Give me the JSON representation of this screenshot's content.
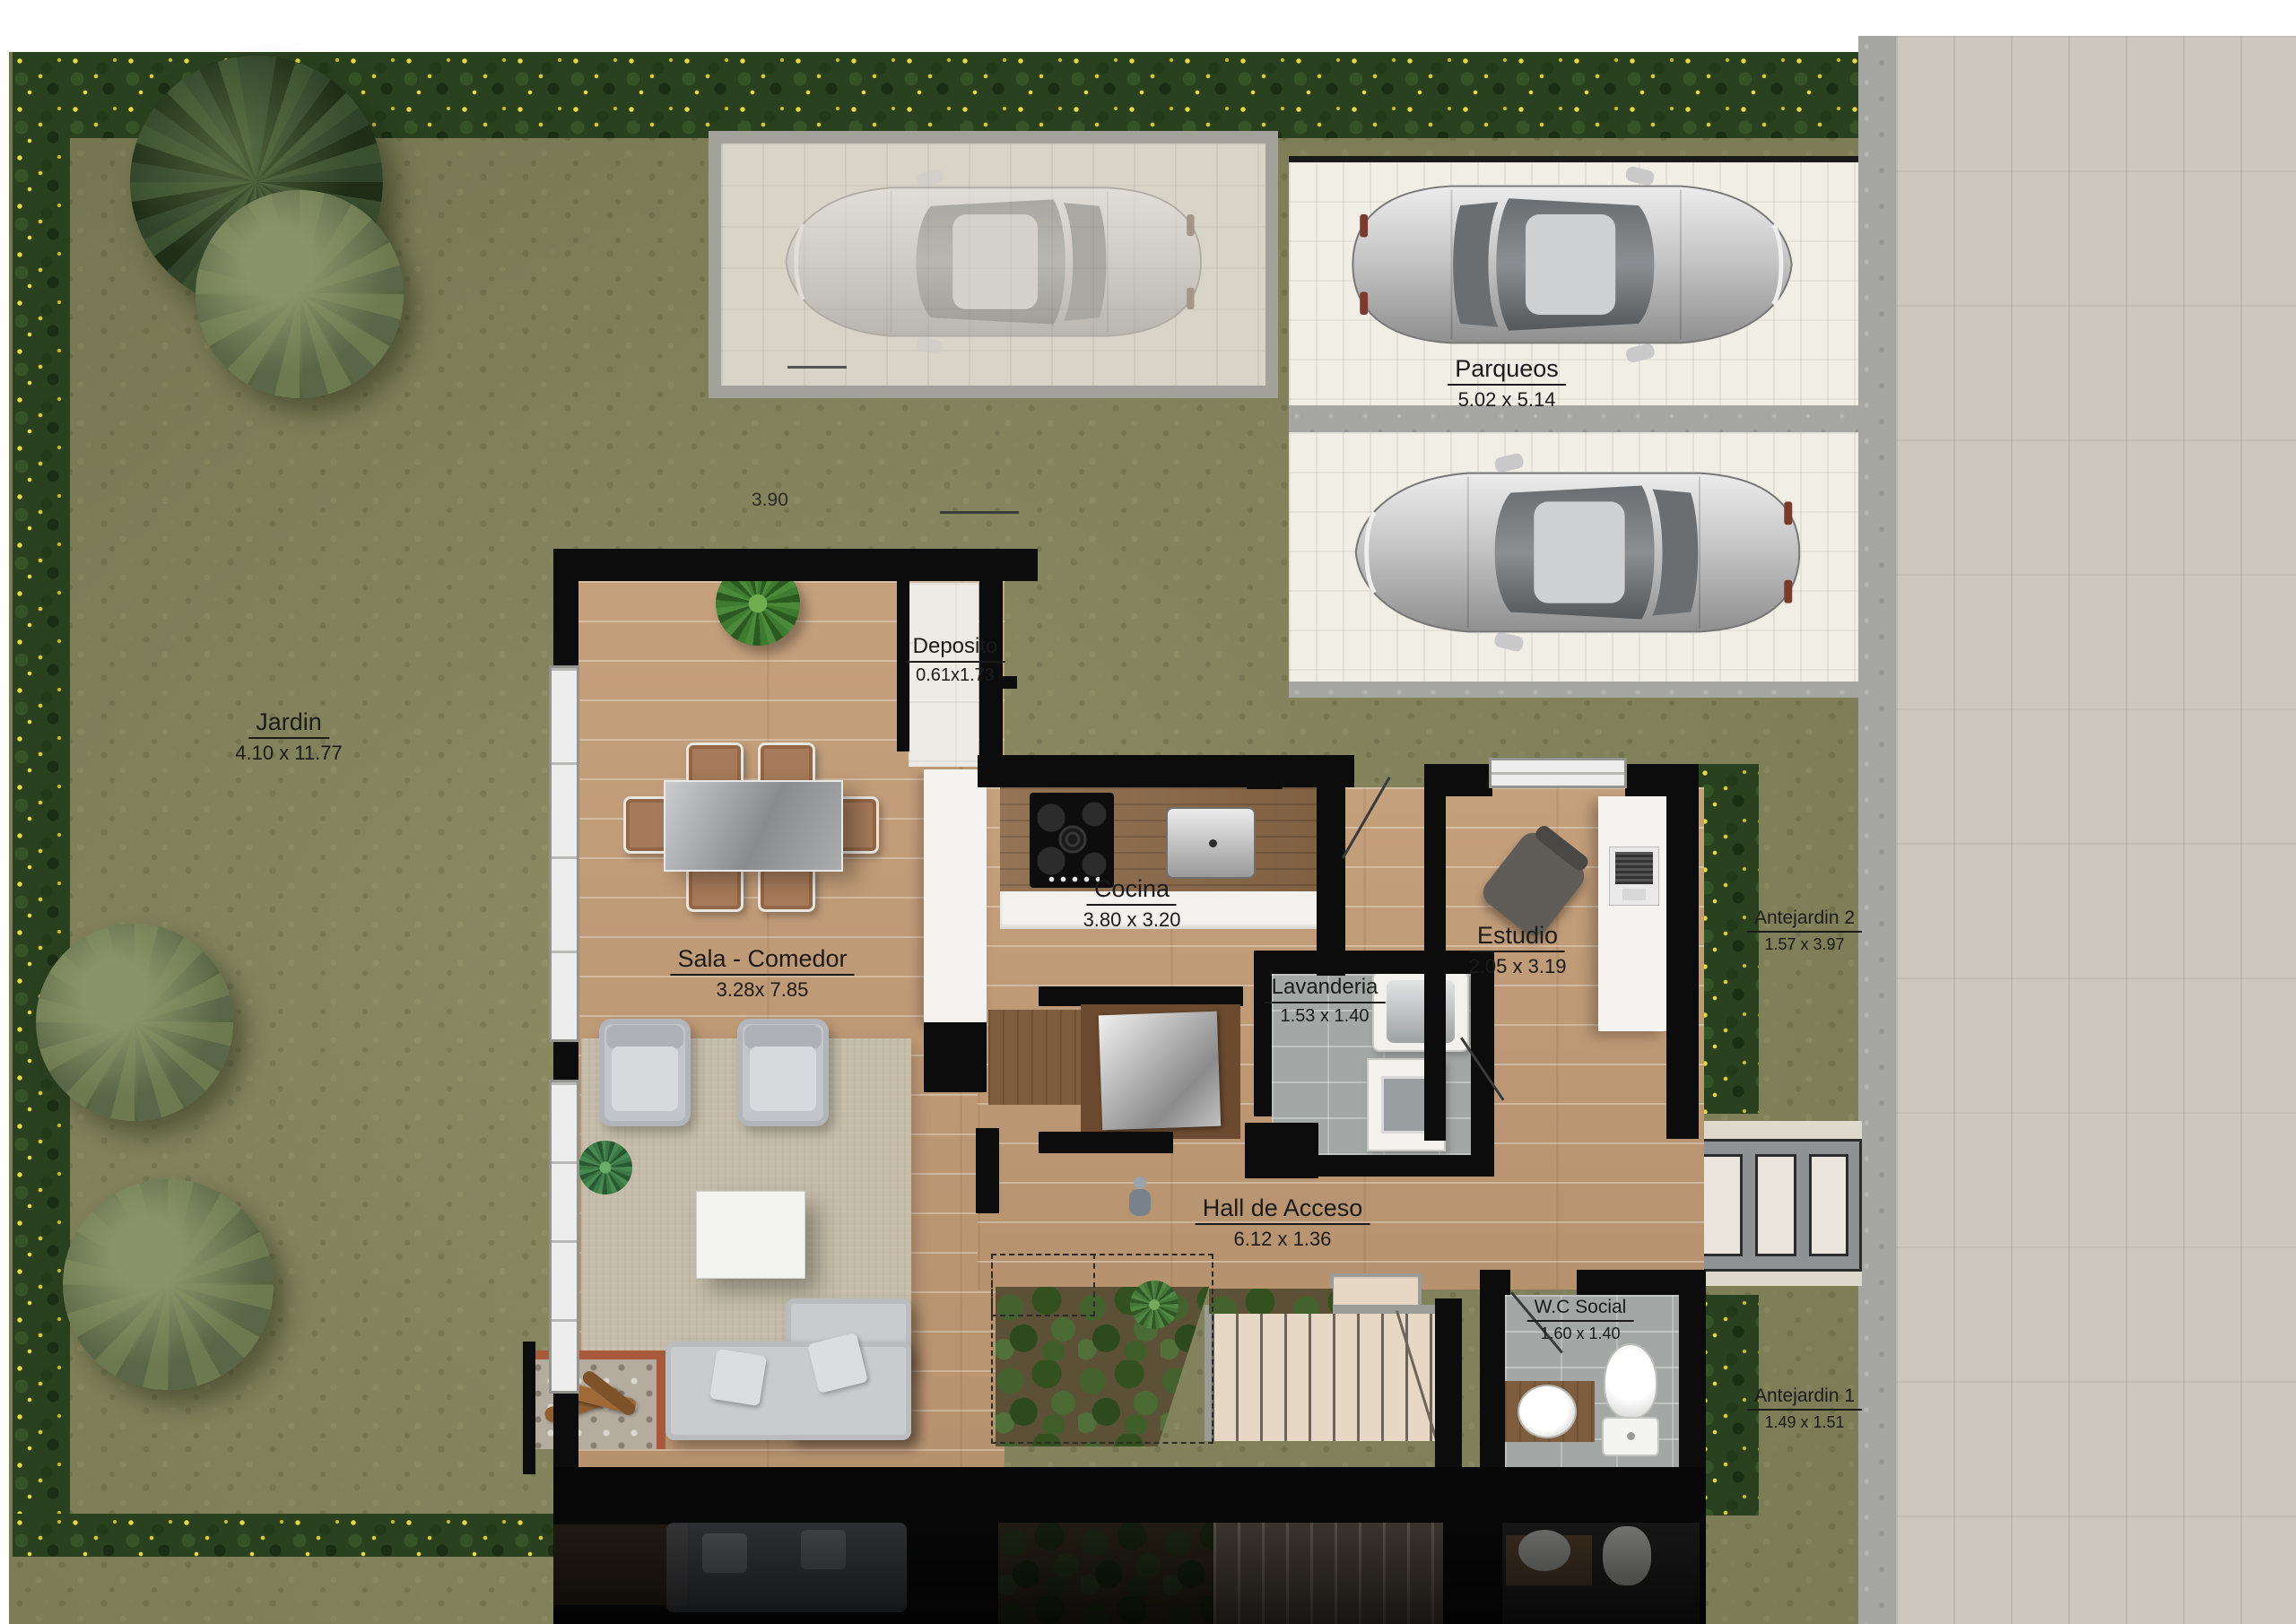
{
  "labels": {
    "parqueos": {
      "name": "Parqueos",
      "dims": "5.02 x 5.14"
    },
    "jardin": {
      "name": "Jardin",
      "dims": "4.10 x 11.77"
    },
    "deposito": {
      "name": "Deposito",
      "dims": "0.61x1.73"
    },
    "cocina": {
      "name": "Cocina",
      "dims": "3.80 x 3.20"
    },
    "estudio": {
      "name": "Estudio",
      "dims": "2.05 x 3.19"
    },
    "sala_comedor": {
      "name": "Sala - Comedor",
      "dims": "3.28x 7.85"
    },
    "lavanderia": {
      "name": "Lavanderia",
      "dims": "1.53 x 1.40"
    },
    "hall_acceso": {
      "name": "Hall de Acceso",
      "dims": "6.12 x 1.36"
    },
    "wc_social": {
      "name": "W.C Social",
      "dims": "1.60 x 1.40"
    },
    "antejardin2": {
      "name": "Antejardin 2",
      "dims": "1.57 x 3.97"
    },
    "antejardin1": {
      "name": "Antejardin 1",
      "dims": "1.49 x 1.51"
    }
  },
  "annotations": {
    "dim_390": "3.90"
  },
  "palette": {
    "grass": "#85855d",
    "hedge_green": "#2a411f",
    "hedge_flower_yellow": "#e7d847",
    "wall_black": "#0c0c0c",
    "wood_floor": "#c29b76",
    "counter_wood": "#8b6847",
    "pale_stair_wood": "#e7d8c5",
    "white_tile": "#edebe5",
    "gray_tile": "#a3a7a5",
    "rug_beige": "#c5bda9",
    "sidewalk_paver": "#ccc7bf",
    "concrete_strip": "#a6a6a3",
    "stall_paver": "#f1eee6",
    "car_silver": "#c9c9c9",
    "label_text": "#1b1b1b"
  },
  "objects": {
    "ghost_car": "faded car on carport pad",
    "parked_car_upper": "silver car in upper parking stall",
    "parked_car_lower": "silver car in lower parking stall",
    "dining_set": "dining table with six chairs",
    "living_set": "sofa, two armchairs, coffee table on rug",
    "fireplace": "log fireplace",
    "kitchen_counter": "counter with cooktop and sink",
    "kitchen_island": "white island counter",
    "study_desk": "desk with laptop and office chair",
    "laundry_fixtures": "laundry sink and washer",
    "wc_fixtures": "toilet and round basin on wood vanity",
    "stairs": "staircase with planter",
    "entry_walkway": "three-panel entry walkway",
    "trees": "garden trees and hedges",
    "person": "small human figure in hall"
  }
}
